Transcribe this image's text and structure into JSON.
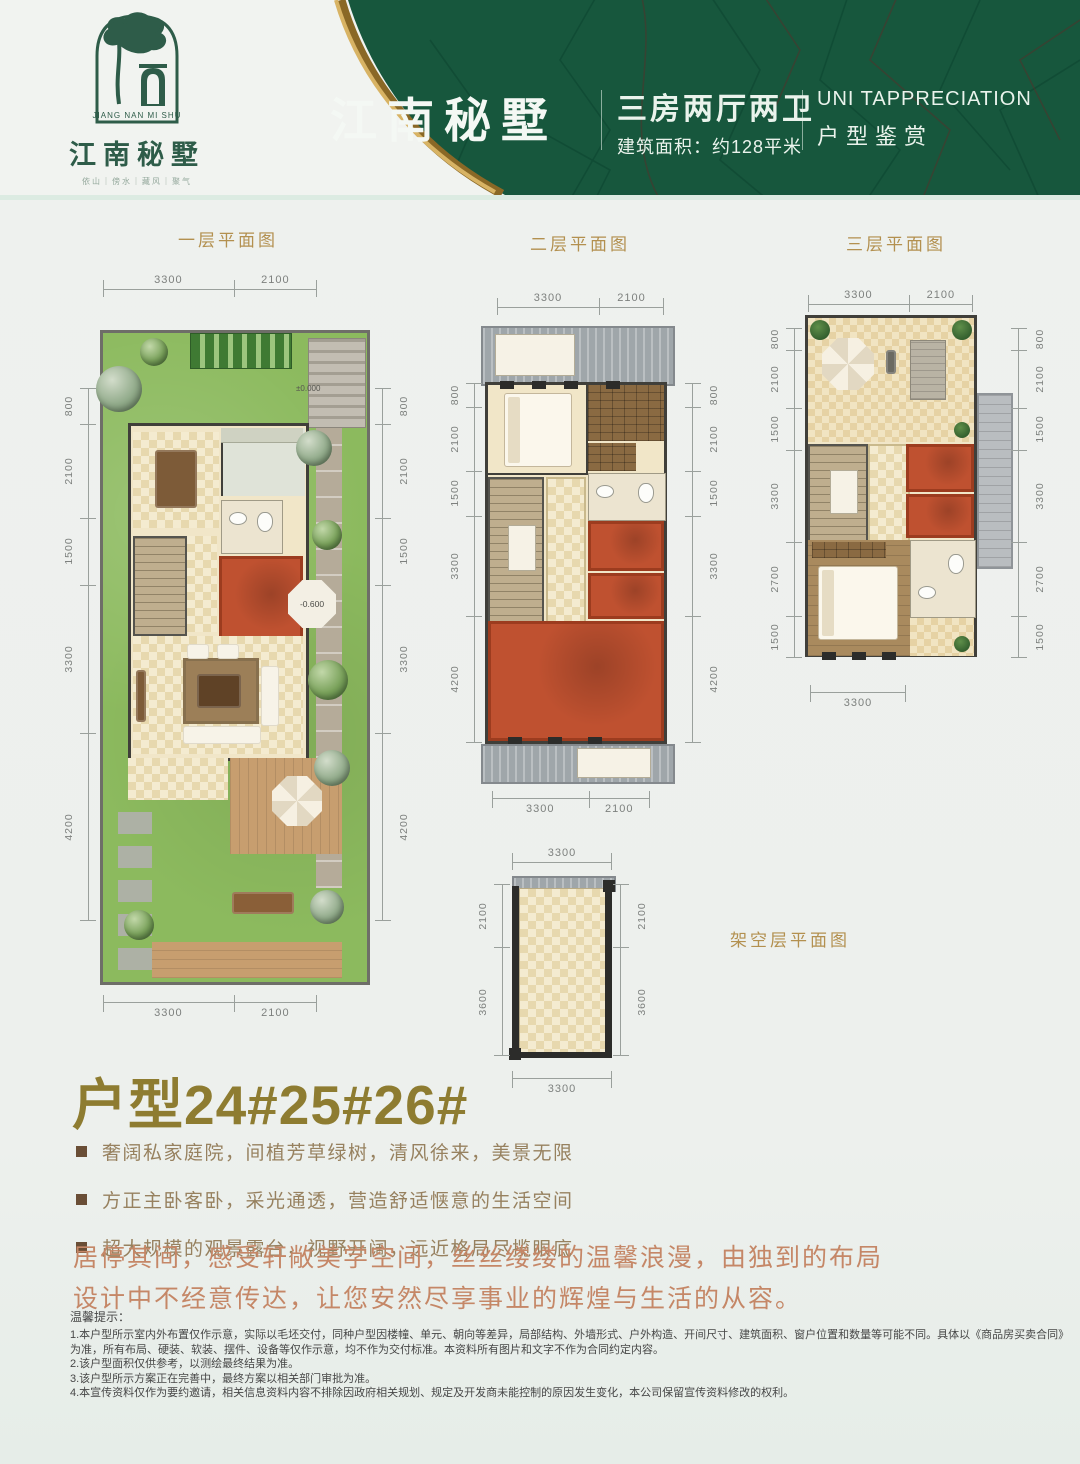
{
  "colors": {
    "header_green": "#17573d",
    "gold_accent": "#b3904f",
    "red_room": "#bf5130",
    "unit_title_olive": "#8e7c31",
    "slogan_red": "#c58767",
    "feature_text_brown": "#97815f"
  },
  "header": {
    "logo": {
      "brand_en": "JIANG NAN MI SHU",
      "brand_cn": "江南秘墅",
      "tagline": "依山｜傍水｜藏风｜聚气"
    },
    "title": "江南秘墅",
    "spec_title": "三房两厅两卫",
    "spec_sub": "建筑面积：约128平米",
    "right_en": "UNI TAPPRECIATION",
    "right_cn": "户型鉴赏"
  },
  "plans": [
    {
      "title": "一层平面图",
      "dims": {
        "top": [
          "3300",
          "2100"
        ],
        "bottom": [
          "3300",
          "2100"
        ],
        "left": [
          "800",
          "2100",
          "1500",
          "3300",
          "4200"
        ],
        "right": [
          "800",
          "2100",
          "1500",
          "3300",
          "4200"
        ]
      },
      "elevation_marker": "-0.600",
      "entry_marker": "±0.000"
    },
    {
      "title": "二层平面图",
      "dims": {
        "top": [
          "3300",
          "2100"
        ],
        "bottom": [
          "3300",
          "2100"
        ],
        "left": [
          "800",
          "2100",
          "1500",
          "3300",
          "4200"
        ],
        "right": [
          "800",
          "2100",
          "1500",
          "3300",
          "4200"
        ]
      }
    },
    {
      "title": "三层平面图",
      "dims": {
        "top": [
          "3300",
          "2100"
        ],
        "bottom": [
          "3300"
        ],
        "left": [
          "800",
          "2100",
          "1500",
          "3300",
          "2700",
          "1500"
        ],
        "right": [
          "800",
          "2100",
          "1500",
          "3300",
          "2700",
          "1500"
        ]
      }
    }
  ],
  "stilt_plan": {
    "title": "架空层平面图",
    "dims": {
      "top": [
        "3300"
      ],
      "bottom": [
        "3300"
      ],
      "left": [
        "2100",
        "3600"
      ],
      "right": [
        "2100",
        "3600"
      ]
    }
  },
  "unit_title": "户型24#25#26#",
  "features": [
    "奢阔私家庭院，间植芳草绿树，清风徐来，美景无限",
    "方正主卧客卧，采光通透，营造舒适惬意的生活空间",
    "超大规模的观景露台，视野开阔，远近格局尽揽眼底"
  ],
  "slogan": {
    "line1": "居停其间，感受轩敞美学空间，丝丝缕缕的温馨浪漫，由独到的布局",
    "line2": "设计中不经意传达，让您安然尽享事业的辉煌与生活的从容。"
  },
  "notice": {
    "title": "温馨提示：",
    "items": [
      "1.本户型所示室内外布置仅作示意，实际以毛坯交付，同种户型因楼幢、单元、朝向等差异，局部结构、外墙形式、户外构造、开间尺寸、建筑面积、窗户位置和数量等可能不同。具体以《商品房买卖合同》为准，所有布局、硬装、软装、摆件、设备等仅作示意，均不作为交付标准。本资料所有图片和文字不作为合同约定内容。",
      "2.该户型面积仅供参考，以测绘最终结果为准。",
      "3.该户型所示方案正在完善中，最终方案以相关部门审批为准。",
      "4.本宣传资料仅作为要约邀请，相关信息资料内容不排除因政府相关规划、规定及开发商未能控制的原因发生变化，本公司保留宣传资料修改的权利。"
    ]
  }
}
